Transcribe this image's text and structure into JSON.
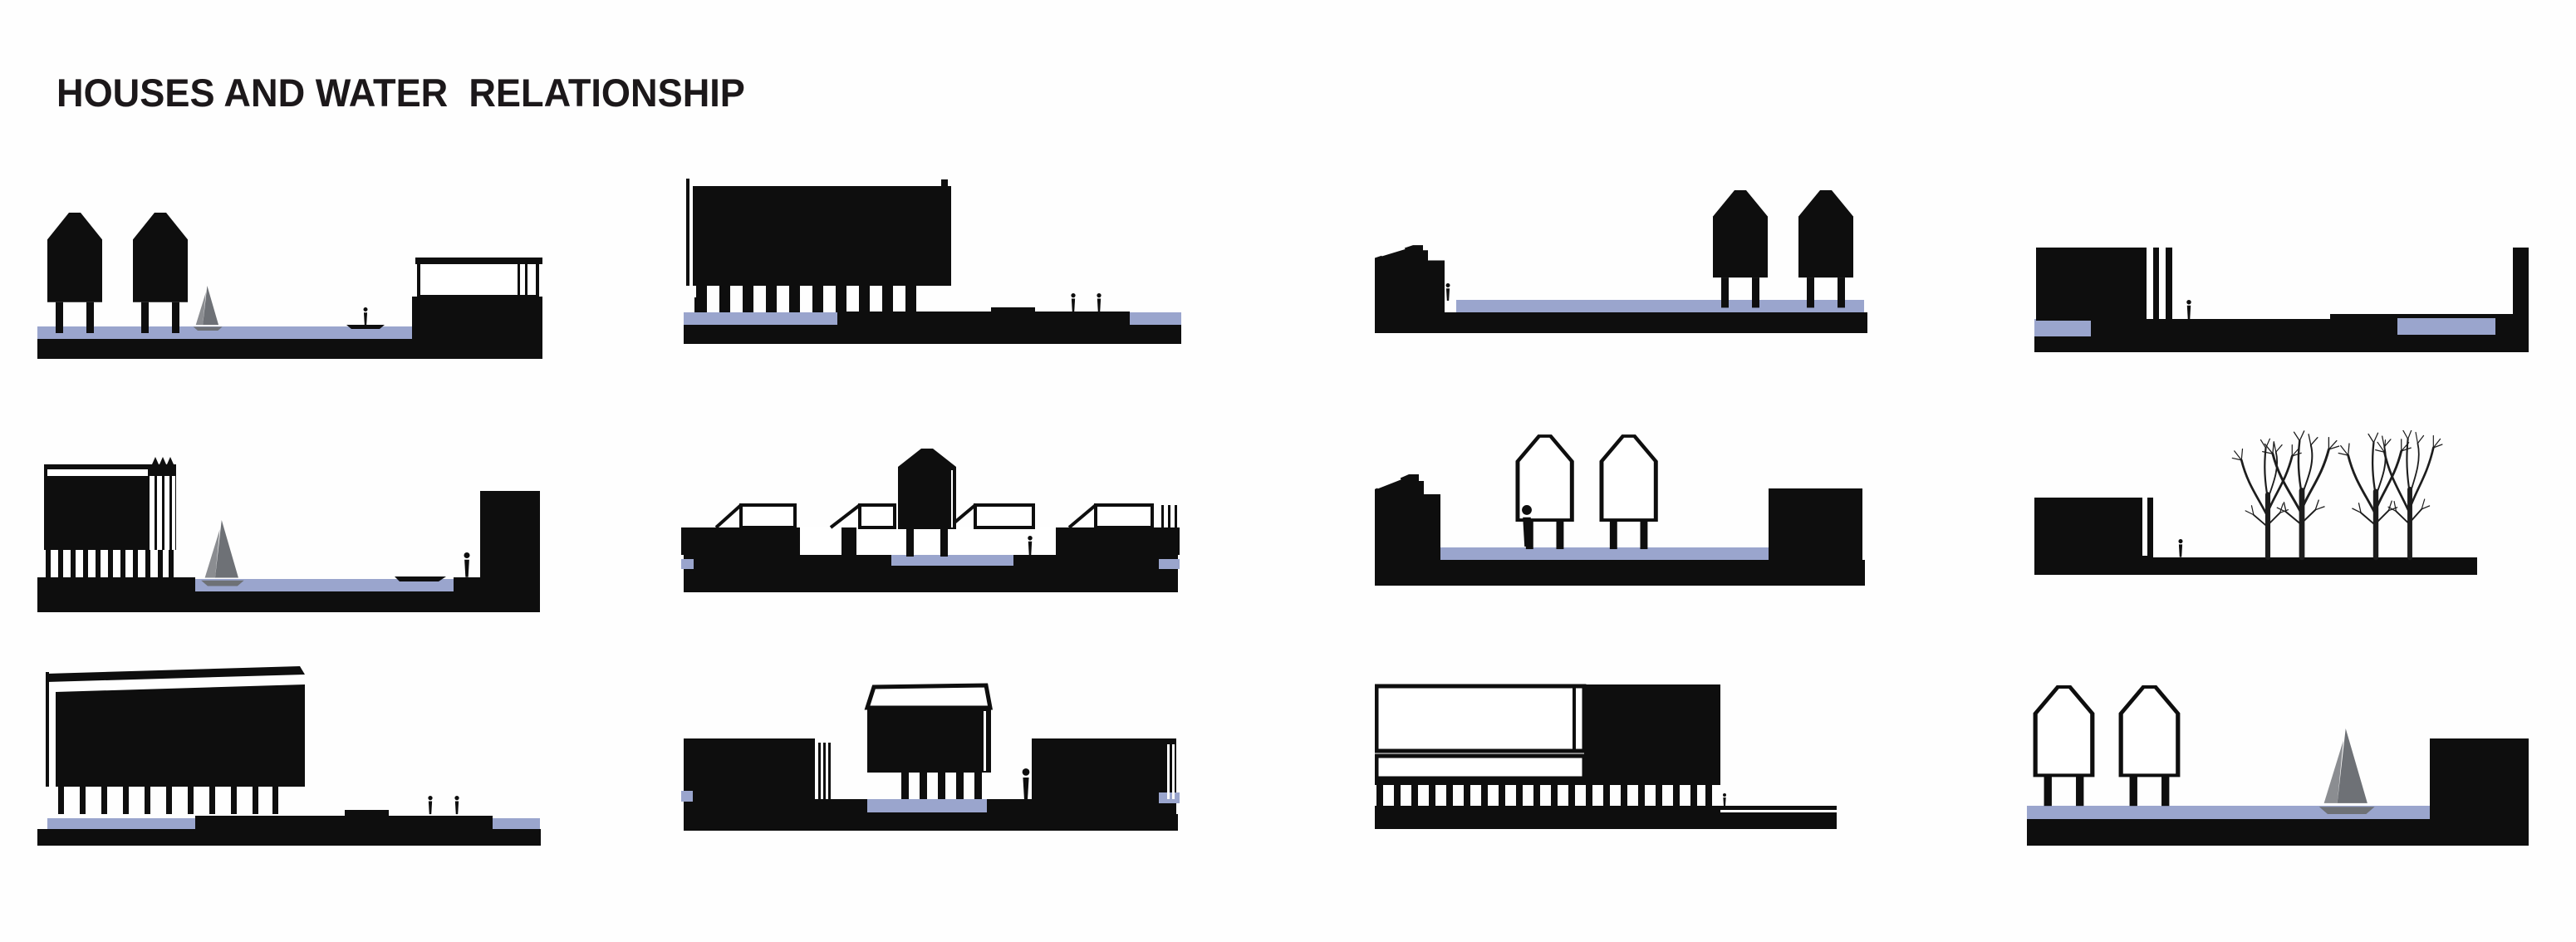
{
  "title": "HOUSES AND WATER  RELATIONSHIP",
  "colors": {
    "ink": "#0e0e0e",
    "water": "#9aa5cd",
    "boat": "#6e7176",
    "background": "#fefefe"
  },
  "grid": {
    "rows": 3,
    "cols": 4,
    "count": 12
  },
  "diagrams": [
    {
      "id": "r1c1",
      "label": "two stilt houses standing in water with sailboat, paddler on board and waterside pavilion on quay"
    },
    {
      "id": "r1c2",
      "label": "large solid block raised on piles over water next to a quay with two people and water beyond"
    },
    {
      "id": "r1c3",
      "label": "barn house on raised bank with person facing two stilt houses standing in water"
    },
    {
      "id": "r1c4",
      "label": "solid building with slit openings, sunken water pools set into the ground and an end wall"
    },
    {
      "id": "r2c1",
      "label": "slatted block on piles above land overlooking a sunken boat basin with sailboat, rowboat, person and solid block"
    },
    {
      "id": "r2c2",
      "label": "central stilt house over a pool among outlined sheds on a black pier platform with water pockets"
    },
    {
      "id": "r2c3",
      "label": "barn house on bank facing two outlined stilt houses in a shallow water sheet and a solid block"
    },
    {
      "id": "r2c4",
      "label": "solid building with slit opening, person and a grove of bare trees on land, no water"
    },
    {
      "id": "r3c1",
      "label": "shed-roofed block on piles over water beside a quay with bench, two people and water at far end"
    },
    {
      "id": "r3c2",
      "label": "gabled house on stilts over a pool in a courtyard carved between two solid masses with corner pools"
    },
    {
      "id": "r3c3",
      "label": "long half-open, half-solid slab building raised on short piles above dry land with person"
    },
    {
      "id": "r3c4",
      "label": "two outlined stilt houses standing in water with sailboat and solid block at the water edge"
    }
  ]
}
